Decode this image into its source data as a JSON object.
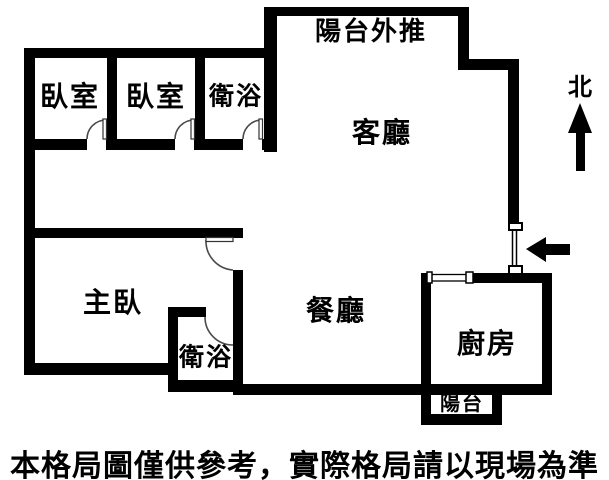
{
  "plan": {
    "labels": {
      "balcony_extension": "陽台外推",
      "living_room": "客廳",
      "bedroom_1": "臥室",
      "bedroom_2": "臥室",
      "bathroom_top": "衛浴",
      "master_bedroom": "主臥",
      "dining_room": "餐廳",
      "bathroom_mid": "衛浴",
      "kitchen": "廚房",
      "balcony": "陽台"
    },
    "compass": {
      "north": "北"
    },
    "icons": {
      "north_arrow": "up-arrow",
      "entrance_arrow": "left-arrow",
      "door_swings": "quarter-circle-arc",
      "window": "double-line-window"
    },
    "colors": {
      "wall": "#000000",
      "background": "#ffffff",
      "door_arc": "#4a4a4a",
      "text": "#000000"
    }
  },
  "disclaimer": "本格局圖僅供參考，實際格局請以現場為準"
}
